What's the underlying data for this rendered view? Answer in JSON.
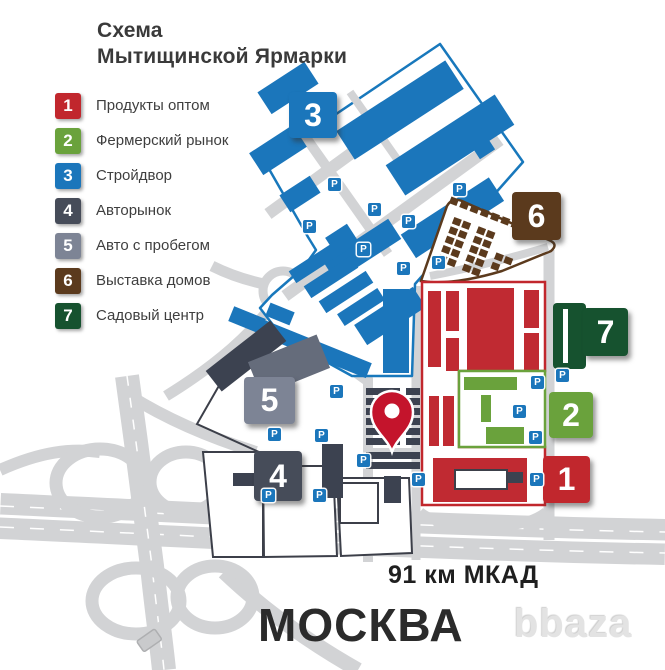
{
  "title": {
    "line1": "Схема",
    "line2": "Мытищинской Ярмарки"
  },
  "legend": {
    "items": [
      {
        "number": "1",
        "label": "Продукты оптом",
        "color": "#c1272d"
      },
      {
        "number": "2",
        "label": "Фермерский рынок",
        "color": "#6aa23c"
      },
      {
        "number": "3",
        "label": "Стройдвор",
        "color": "#1b76bb"
      },
      {
        "number": "4",
        "label": "Авторынок",
        "color": "#464c59"
      },
      {
        "number": "5",
        "label": "Авто с пробегом",
        "color": "#7d8495"
      },
      {
        "number": "6",
        "label": "Выставка домов",
        "color": "#5b3a1d"
      },
      {
        "number": "7",
        "label": "Садовый центр",
        "color": "#16522f"
      }
    ]
  },
  "map": {
    "parking_label": "P",
    "pin_color": "#c4142c",
    "road_color": "#d2d3d5"
  },
  "footer": {
    "highway_label": "91 км МКАД",
    "city_label": "МОСКВА"
  },
  "watermark": "bbaza"
}
